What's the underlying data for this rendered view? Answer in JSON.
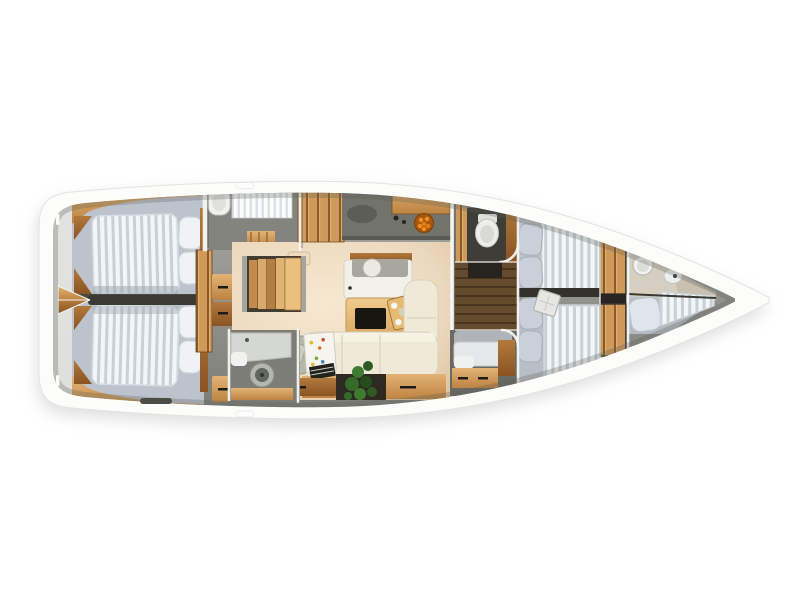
{
  "scene": "sailing-yacht-interior-floorplan-top-view",
  "background": "#ffffff",
  "palette": {
    "bg": "#ffffff",
    "hull": "#fcfcfb",
    "hullEdge": "#e3e3e1",
    "shadow": "#bfbfbf",
    "deckTop": "#a6a8a1",
    "deckBot": "#7c7e77",
    "bedBase": "#bcc3cc",
    "mattress": "#f3f6f7",
    "mattressStripe": "#c7d0d8",
    "pillow": "#f0f3f6",
    "pillowFore": "#c9d0d9",
    "wallWhite": "#f5f5f3",
    "floorBeige": "#ecd8bd",
    "floorLight": "#f6e8cf",
    "counterGray": "#72746b",
    "sofaCream": "#efe9d7",
    "tableWood": "#e9c185",
    "woodLight": "#e3b375",
    "woodMid": "#c9904f",
    "woodDark": "#8a5423",
    "plantGreen": "#356b28",
    "fruitOrange": "#ef9025",
    "fixture": "#f1f2f0",
    "darkFloor": "#3e3d37"
  },
  "regions": [
    {
      "id": "stern-swim-platform",
      "features": [
        "lazarette-vent"
      ]
    },
    {
      "id": "aft-cabin-port",
      "features": [
        "double-berth",
        "striped-mattress",
        "two-pillows",
        "wood-trim"
      ]
    },
    {
      "id": "aft-cabin-starboard",
      "features": [
        "double-berth",
        "striped-mattress",
        "two-pillows",
        "wood-trim"
      ]
    },
    {
      "id": "stern-centerline-lockers",
      "features": [
        "wood-wedge-doors"
      ]
    },
    {
      "id": "wardrobe-dressers",
      "features": [
        "drawer-handles"
      ]
    },
    {
      "id": "aft-head-port",
      "features": [
        "sink",
        "shower-screen",
        "teak-mat"
      ]
    },
    {
      "id": "aft-head-starboard",
      "features": [
        "shower-pan",
        "washer-drum"
      ]
    },
    {
      "id": "companionway-stairs",
      "features": [
        "wood-steps"
      ]
    },
    {
      "id": "galley",
      "features": [
        "l-shaped-counter",
        "sink-faucet",
        "fruit-bowl",
        "wood-cabinets"
      ]
    },
    {
      "id": "salon",
      "features": [
        "sideboard",
        "round-tray",
        "dining-table",
        "serving-tray",
        "l-sofa",
        "potted-plant",
        "under-sofa-drawers"
      ]
    },
    {
      "id": "nav-station",
      "features": [
        "seat-cushion",
        "chart-with-markers",
        "book-stack"
      ]
    },
    {
      "id": "mid-head",
      "features": [
        "toilet",
        "curved-wall"
      ]
    },
    {
      "id": "mid-berth",
      "features": [
        "molded-bunk",
        "drawers",
        "dresser"
      ]
    },
    {
      "id": "forward-cabin",
      "features": [
        "v-berth",
        "striped-mattresses",
        "gray-pillows",
        "tilted-deck-hatch",
        "wood-doors"
      ]
    },
    {
      "id": "bow-head",
      "features": [
        "round-sink",
        "faucet",
        "toilet-bowl"
      ]
    },
    {
      "id": "bow-berth",
      "features": [
        "pillow",
        "striped-mattress"
      ]
    }
  ]
}
